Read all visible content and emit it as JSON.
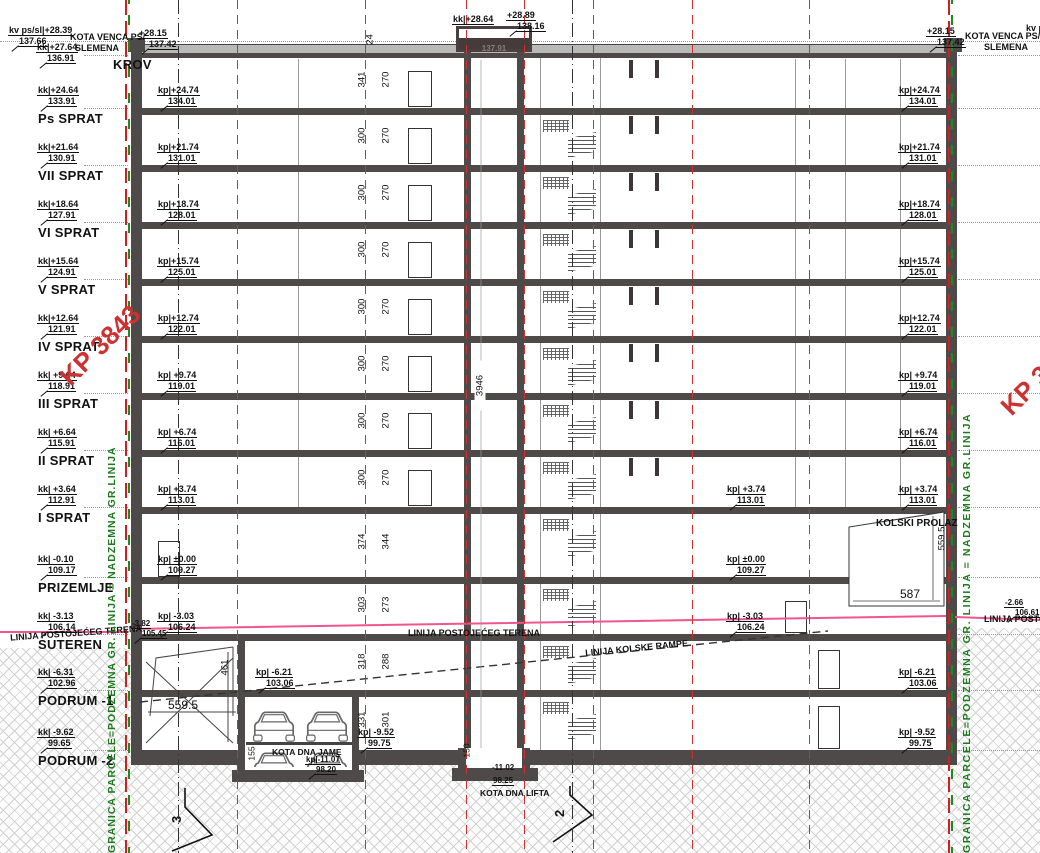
{
  "top": {
    "kv": "kv ps/sl|+28.39",
    "kv_abs": "137.66",
    "kota_venca": "KOTA VENCA PS/",
    "slemena": "SLEMENA",
    "kk": "kk|+27.64",
    "kk_abs": "136.91",
    "venac": "+28.15",
    "venac_abs": "137.42",
    "krov": "KROV",
    "lift_kk": "kk|+28.64",
    "lift_kk_abs": "137.91",
    "lift_top": "+28.89",
    "lift_top_abs": "138.16",
    "kv_right": "kv ps"
  },
  "floors": [
    {
      "name": "Ps SPRAT",
      "kk": "kk|+24.64",
      "kk_abs": "133.91",
      "kp": "kp|+24.74",
      "kp_abs": "134.01",
      "h1": "341",
      "h2": "270"
    },
    {
      "name": "VII SPRAT",
      "kk": "kk|+21.64",
      "kk_abs": "130.91",
      "kp": "kp|+21.74",
      "kp_abs": "131.01",
      "h1": "300",
      "h2": "270"
    },
    {
      "name": "VI SPRAT",
      "kk": "kk|+18.64",
      "kk_abs": "127.91",
      "kp": "kp|+18.74",
      "kp_abs": "128.01",
      "h1": "300",
      "h2": "270"
    },
    {
      "name": "V SPRAT",
      "kk": "kk|+15.64",
      "kk_abs": "124.91",
      "kp": "kp|+15.74",
      "kp_abs": "125.01",
      "h1": "300",
      "h2": "270"
    },
    {
      "name": "IV SPRAT",
      "kk": "kk|+12.64",
      "kk_abs": "121.91",
      "kp": "kp|+12.74",
      "kp_abs": "122.01",
      "h1": "300",
      "h2": "270"
    },
    {
      "name": "III SPRAT",
      "kk": "kk| +9.64",
      "kk_abs": "118.91",
      "kp": "kp| +9.74",
      "kp_abs": "119.01",
      "h1": "300",
      "h2": "270"
    },
    {
      "name": "II SPRAT",
      "kk": "kk| +6.64",
      "kk_abs": "115.91",
      "kp": "kp| +6.74",
      "kp_abs": "116.01",
      "h1": "300",
      "h2": "270"
    },
    {
      "name": "I SPRAT",
      "kk": "kk| +3.64",
      "kk_abs": "112.91",
      "kp": "kp| +3.74",
      "kp_abs": "113.01",
      "h1": "300",
      "h2": "270"
    },
    {
      "name": "PRIZEMLJE",
      "kk": "kk| -0.10",
      "kk_abs": "109.17",
      "kp": "kp| ±0.00",
      "kp_abs": "109.27",
      "h1": "374",
      "h2": "344"
    },
    {
      "name": "SUTEREN",
      "kk": "kk| -3.13",
      "kk_abs": "106.14",
      "kp": "kp| -3.03",
      "kp_abs": "106.24",
      "h1": "303",
      "h2": "273"
    },
    {
      "name": "PODRUM -1",
      "kk": "kk| -6.31",
      "kk_abs": "102.96",
      "kp": "kp| -6.21",
      "kp_abs": "103.06",
      "h1": "318",
      "h2": "288"
    },
    {
      "name": "PODRUM -2",
      "kk": "kk| -9.62",
      "kk_abs": "99.65",
      "kp": "kp| -9.52",
      "kp_abs": "99.75",
      "h1": "331",
      "h2": "301"
    }
  ],
  "dims": {
    "parapet": "24",
    "total": "3946",
    "lift_pit": "150",
    "jame_pit": "155",
    "ramp_h": "461",
    "ramp_l": "559.5",
    "prolaz_h": "559.5",
    "prolaz_w": "587"
  },
  "notes": {
    "kolski_prolaz": "KOLSKI PROLAZ",
    "teren": "LINIJA POSTOJEĆEG TERENA",
    "rampa": "LINIJA KOLSKE RAMPE",
    "dna_jame": "KOTA DNA JAME",
    "jame_kp": "kp|-11.07",
    "jame_abs": "98.20",
    "dna_lifta": "KOTA DNA LIFTA",
    "lift_v": "-11.02",
    "lift_abs": "98.25",
    "sut_v": "-3.82",
    "sut_abs": "105.45",
    "right_v": "-2.66",
    "right_abs": "106.61"
  },
  "parcels": {
    "left": "KP 3843",
    "right": "KP 38"
  },
  "boundary": {
    "label": "GRANICA PARCELE=PODZEMNA GR. LINIJA = NADZEMNA GR.LINIJA"
  },
  "markers": {
    "left": "3",
    "right": "2"
  },
  "colors": {
    "axis_red": "#d23030",
    "boundary_green": "#1c8a1c",
    "terrain_pink": "#f0558d",
    "parcel_red": "#cd3232",
    "wall_gray": "#4f4a4a"
  }
}
